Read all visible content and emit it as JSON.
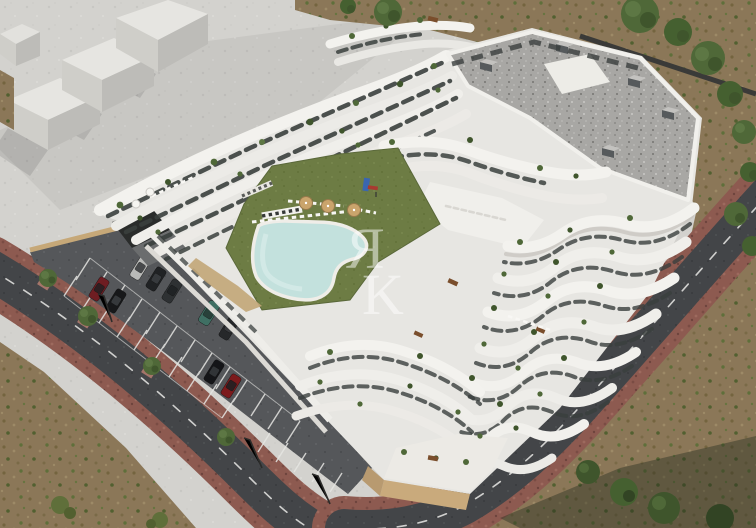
{
  "meta": {
    "title": "Aerial 3D architectural render of a terraced white apartment complex",
    "view": "aerial isometric render",
    "scene_summary": "U-shaped modern white residential building with stepped curved balcony terraces around a central courtyard with lawn and free-form pool; open-air parking lot with cars on the left; ring roads with red-brown paved sidewalks; bare dirt field on the right; untextured grey massing blocks of a neighbouring building top-left; semi-transparent monogram watermark in the centre"
  },
  "watermark": {
    "letter_top": "Я",
    "letter_bottom": "K",
    "color": "#ffffff",
    "opacity": 0.5
  },
  "palette": {
    "plaza_grey": "#d3d2ce",
    "massing_top": "#e6e5e1",
    "massing_side": "#bdbcb8",
    "dirt_brown": "#8b7758",
    "scrub_green": "#5f6f3a",
    "road_asphalt": "#434548",
    "road_marking": "#e9e9e6",
    "sidewalk_brick": "#8d5a50",
    "parking_asphalt": "#55575a",
    "parking_line": "#e6e6e3",
    "retaining_wall_tan": "#c6a878",
    "building_white": "#e7e6e2",
    "band_highlight": "#f3f2ee",
    "band_shade": "#c9c6c1",
    "glazing_dark": "#3a3f3d",
    "roof_gravel": "#a8a7a4",
    "lawn_green": "#6d7c44",
    "pool_water": "#c3e1dd",
    "pool_deck": "#efede8",
    "parasol_tan": "#caa46c",
    "tree_green": "#4f6838",
    "tree_green_dark": "#3f552c",
    "podium_tan": "#c9aa7c",
    "garage_dark": "#2a2c2b"
  },
  "scene": {
    "building": {
      "kind": "apartment complex",
      "style": "white terraced wavy balconies, glass railings, roof gardens",
      "roof": "grey gravel flat roof with chimney boxes",
      "visible_floors": 6
    },
    "courtyard": {
      "lawn": true,
      "pool_shape": "free-form",
      "parasol_count": 3,
      "lounger_rows": 3,
      "playground": true
    },
    "parking": {
      "car_count": 9,
      "cars": [
        {
          "color_name": "maroon",
          "hex": "#6e1d22"
        },
        {
          "color_name": "black",
          "hex": "#17181a"
        },
        {
          "color_name": "silver",
          "hex": "#b9bab8"
        },
        {
          "color_name": "black",
          "hex": "#202224"
        },
        {
          "color_name": "dark-grey",
          "hex": "#2e3133"
        },
        {
          "color_name": "teal-suv",
          "hex": "#3f6f63"
        },
        {
          "color_name": "dark-grey",
          "hex": "#26282a"
        },
        {
          "color_name": "black",
          "hex": "#141518"
        },
        {
          "color_name": "dark-red",
          "hex": "#7c1a1c"
        }
      ],
      "tree_count": 4,
      "lamp_count": 3
    },
    "surroundings": {
      "roads": 2,
      "road_marking_style": "white dashed centerline",
      "massing_blocks": 4,
      "dirt_field": true,
      "tree_clusters": "top-right row and bottom-right corner"
    }
  }
}
